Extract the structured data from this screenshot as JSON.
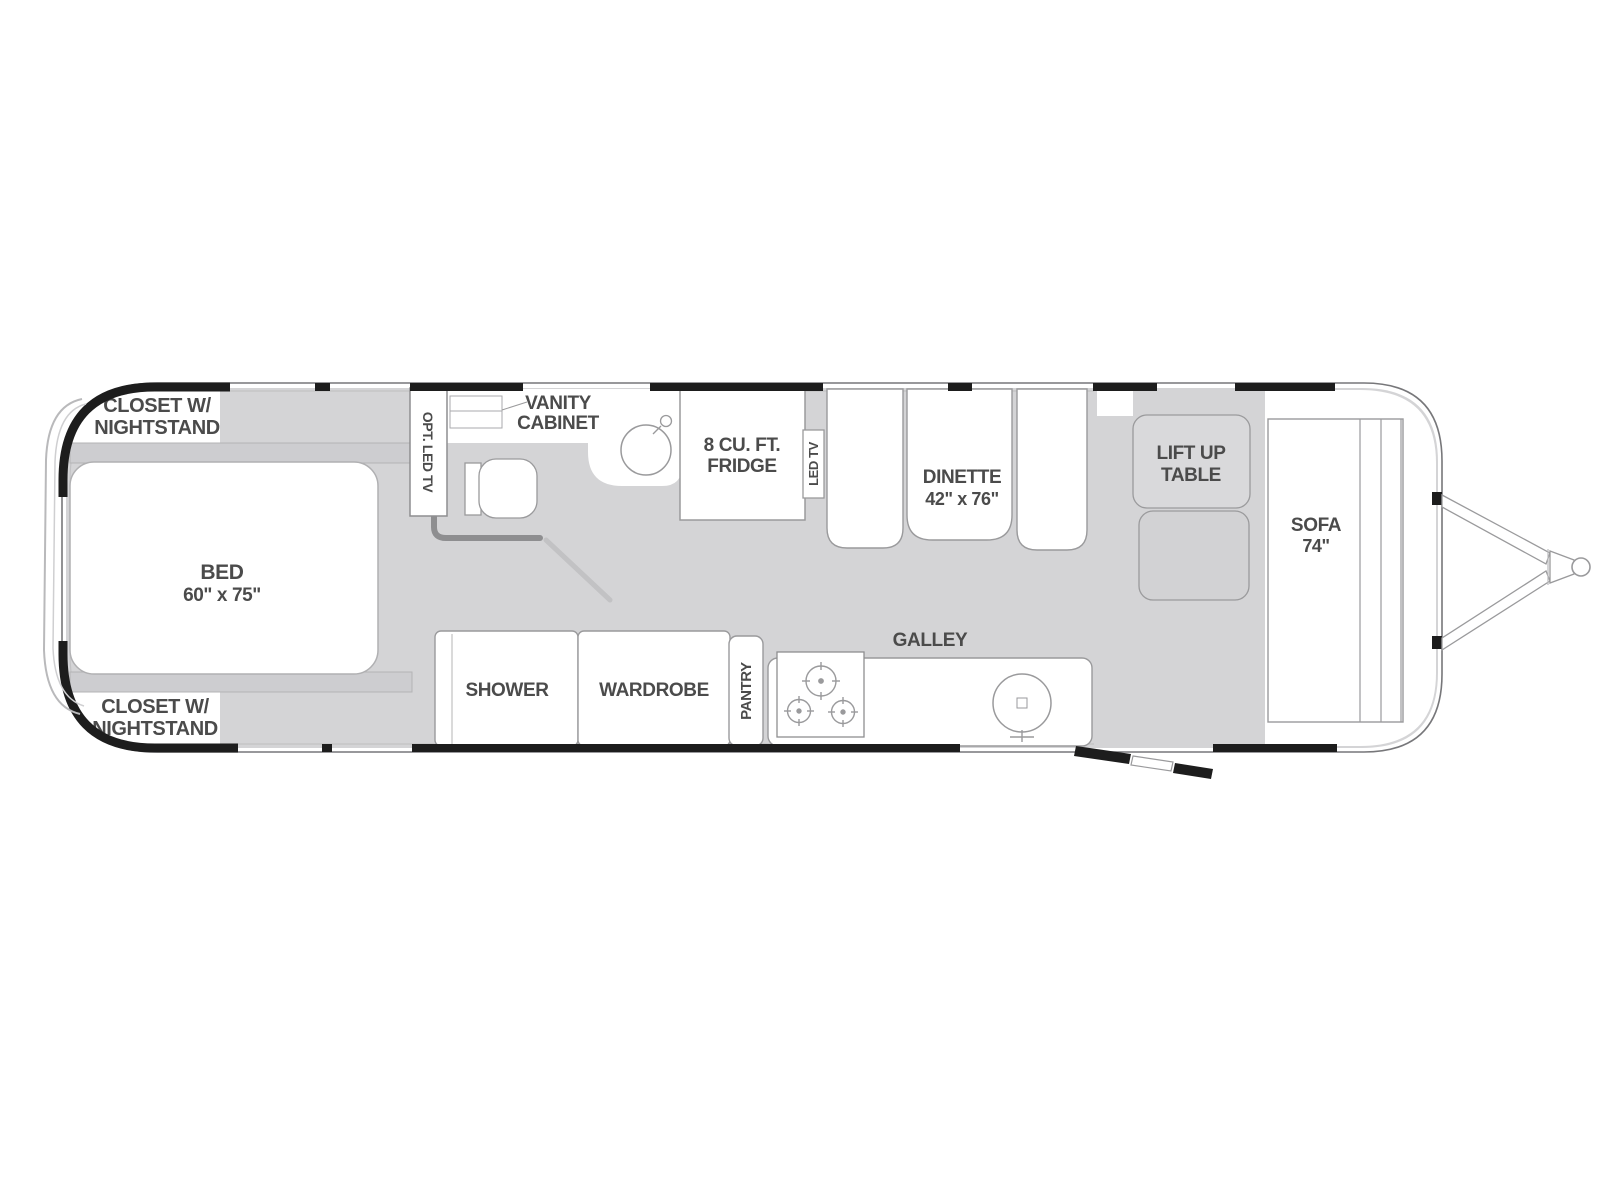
{
  "document": "travel-trailer-floor-plan",
  "labels": {
    "closet_front": [
      "CLOSET W/",
      "NIGHTSTAND"
    ],
    "closet_rear": [
      "CLOSET W/",
      "NIGHTSTAND"
    ],
    "bed": [
      "BED",
      "60\" x 75\""
    ],
    "opt_led_tv": "OPT. LED TV",
    "vanity": [
      "VANITY",
      "CABINET"
    ],
    "fridge": [
      "8 CU. FT.",
      "FRIDGE"
    ],
    "led_tv": "LED TV",
    "dinette": [
      "DINETTE",
      "42\" x 76\""
    ],
    "lift_table": [
      "LIFT UP",
      "TABLE"
    ],
    "sofa": [
      "SOFA",
      "74\""
    ],
    "galley": "GALLEY",
    "shower": "SHOWER",
    "wardrobe": "WARDROBE",
    "pantry": "PANTRY"
  },
  "colors": {
    "floor": "#d4d4d6",
    "cabinet_gray": "#cdcdd0",
    "wall": "#1d1d1d",
    "outline": "#9a9a9c",
    "text": "#4b4b4b",
    "background": "#ffffff"
  }
}
